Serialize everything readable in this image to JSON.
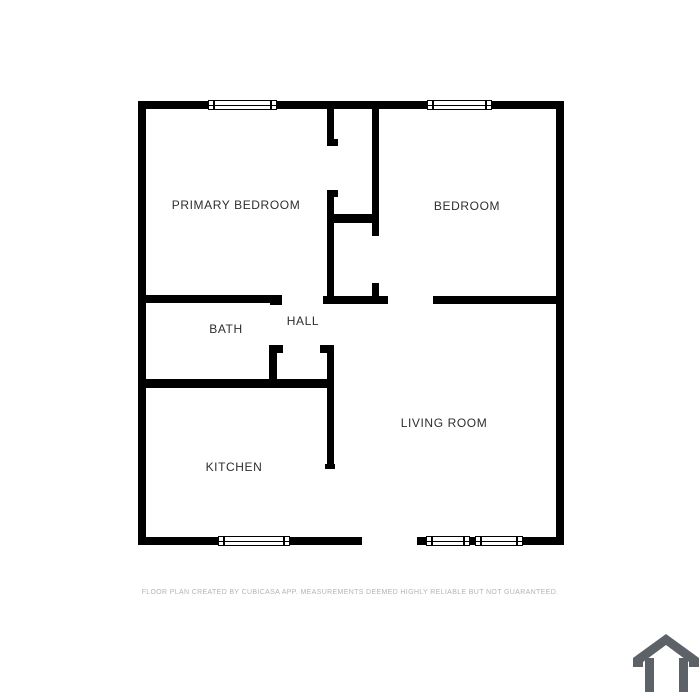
{
  "page": {
    "background": "#ffffff",
    "wall_color": "#000000"
  },
  "floorplan": {
    "rooms": [
      {
        "name": "primary-bedroom",
        "label": "PRIMARY BEDROOM"
      },
      {
        "name": "bedroom",
        "label": "BEDROOM"
      },
      {
        "name": "bath",
        "label": "BATH"
      },
      {
        "name": "hall",
        "label": "HALL"
      },
      {
        "name": "kitchen",
        "label": "KITCHEN"
      },
      {
        "name": "living-room",
        "label": "LIVING ROOM"
      }
    ]
  },
  "footer": {
    "disclaimer": "FLOOR PLAN CREATED BY CUBICASA APP. MEASUREMENTS DEEMED HIGHLY RELIABLE BUT NOT GUARANTEED."
  },
  "branding": {
    "icon": "cubicasa-house-logo-icon",
    "color": "#5c6267"
  }
}
